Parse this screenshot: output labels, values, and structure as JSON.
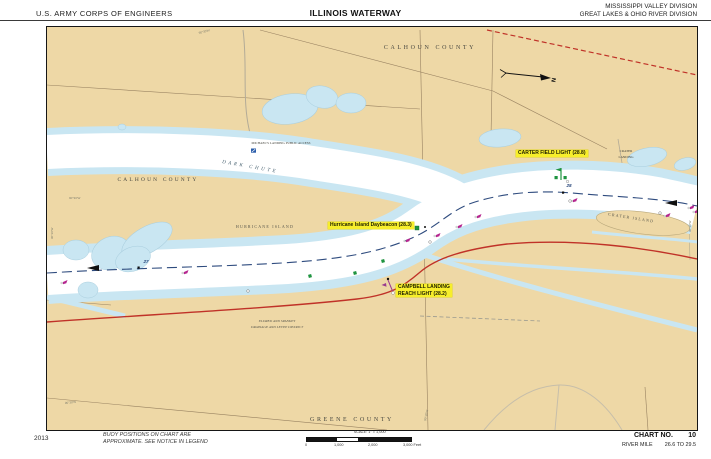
{
  "header": {
    "agency": "U.S. ARMY CORPS OF ENGINEERS",
    "title": "ILLINOIS WATERWAY",
    "division_line1": "MISSISSIPPI VALLEY DIVISION",
    "division_line2": "GREAT LAKES & OHIO RIVER DIVISION"
  },
  "map": {
    "counties": {
      "calhoun_top": "CALHOUN COUNTY",
      "calhoun_left": "CALHOUN COUNTY",
      "greene": "GREENE COUNTY"
    },
    "features": {
      "dark_chute": "DARK CHUTE",
      "hurricane_island": "HURRICANE ISLAND",
      "crater_island": "CRATER ISLAND",
      "crater_landing_line1": "CRATER",
      "crater_landing_line2": "LANDING",
      "public_access": "MICHAEL'S LANDING PUBLIC ACCESS",
      "levee_district_line1": "ELDRED AND SPANKEY",
      "levee_district_line2": "DRAINAGE AND LEVEE DISTRICT"
    },
    "aids_to_navigation": {
      "carter_field_light": "CARTER FIELD LIGHT (28.8)",
      "hurricane_island_daybeacon": "Hurricane Island Daybeacon (28.3)",
      "campbell_landing_line1": "CAMPBELL LANDING",
      "campbell_landing_line2": "REACH LIGHT (28.2)"
    },
    "mile_markers": {
      "mile_27": "27",
      "mile_28": "28"
    },
    "north_label": "N",
    "graticule_label": "90°30'W",
    "buoys": [
      {
        "x": 16,
        "y": 255,
        "t": "r"
      },
      {
        "x": 137,
        "y": 245,
        "t": "r"
      },
      {
        "x": 359,
        "y": 213,
        "t": "r"
      },
      {
        "x": 389,
        "y": 208,
        "t": "r"
      },
      {
        "x": 411,
        "y": 199,
        "t": "r"
      },
      {
        "x": 430,
        "y": 189,
        "t": "r"
      },
      {
        "x": 526,
        "y": 173,
        "t": "r"
      },
      {
        "x": 619,
        "y": 188,
        "t": "r"
      },
      {
        "x": 643,
        "y": 180,
        "t": "r"
      },
      {
        "x": 648,
        "y": 184,
        "t": "r"
      },
      {
        "x": 263,
        "y": 249,
        "t": "g"
      },
      {
        "x": 308,
        "y": 246,
        "t": "g"
      },
      {
        "x": 336,
        "y": 234,
        "t": "g"
      },
      {
        "x": 370,
        "y": 201,
        "t": "d"
      },
      {
        "x": 383,
        "y": 215,
        "t": "w"
      },
      {
        "x": 201,
        "y": 264,
        "t": "w"
      },
      {
        "x": 523,
        "y": 174,
        "t": "w"
      },
      {
        "x": 613,
        "y": 186,
        "t": "w"
      },
      {
        "x": 378,
        "y": 200,
        "t": "b"
      }
    ]
  },
  "footer": {
    "year": "2013",
    "notice_line1": "BUOY POSITIONS ON CHART ARE",
    "notice_line2": "APPROXIMATE. SEE NOTICE IN LEGEND",
    "scale_label": "SCALE: 1\" = 1,000'",
    "scale_ticks": [
      "0",
      "1,000",
      "2,000",
      "3,000 Feet"
    ],
    "chart_no_label": "CHART NO.",
    "chart_no_value": "10",
    "river_mile_label": "RIVER MILE",
    "river_mile_value": "26.6 TO 29.5"
  },
  "colors": {
    "land": "#eed8a6",
    "shallow_water": "#c9e6f2",
    "channel": "#ffffff",
    "highlight_yellow": "#f7ee2b",
    "sailing_line": "#2e4b7e",
    "road_red": "#c03228",
    "green_aid": "#1f9440",
    "red_aid": "#b5258f"
  }
}
